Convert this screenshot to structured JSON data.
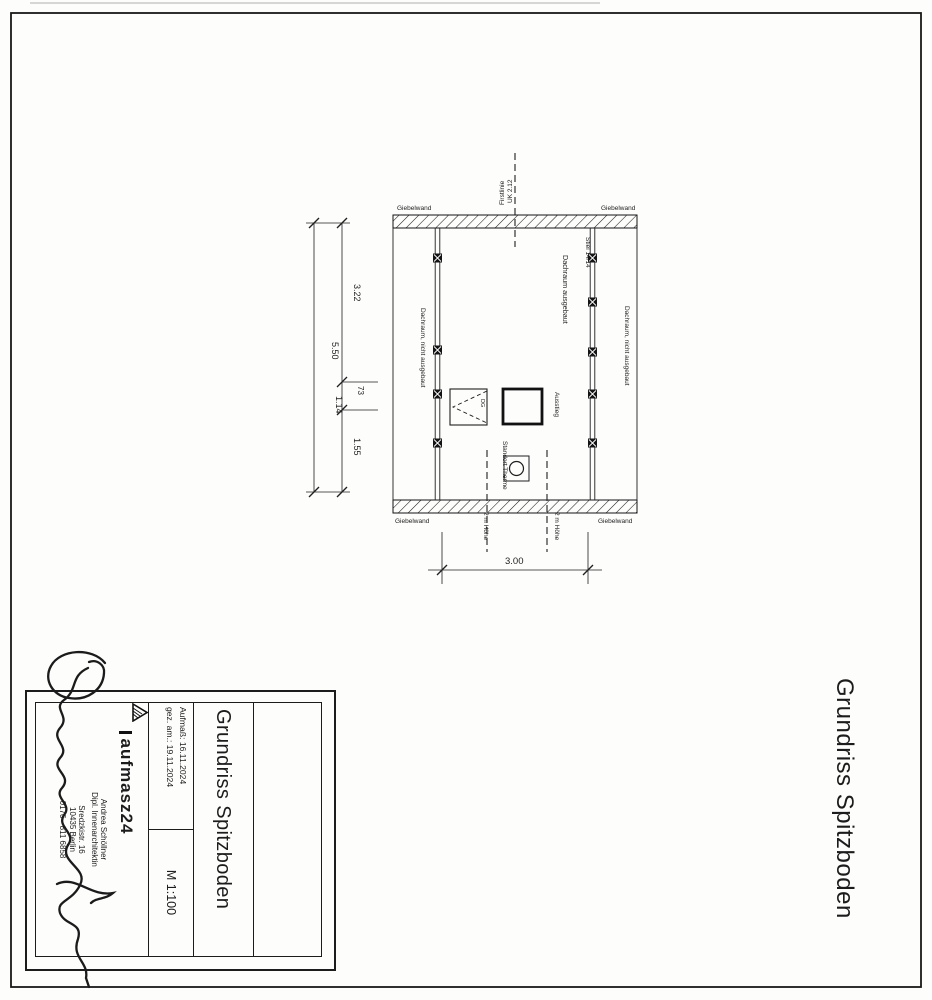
{
  "page": {
    "side_title": "Grundriss Spitzboden"
  },
  "plan": {
    "wall_labels": {
      "top_left": "Giebelwand",
      "top_right": "Giebelwand",
      "bottom_left": "Giebelwand",
      "bottom_right": "Giebelwand"
    },
    "ridge": {
      "line1": "Firstlinie",
      "line2": "UK 2.12"
    },
    "post_label": "Stiel 14/14",
    "room_center": "Dachraum ausgebaut",
    "room_left": "Dachraum, nicht ausgebaut",
    "room_right": "Dachraum, nicht ausgebaut",
    "hatch_note": "DG",
    "exit_label": "Ausstieg",
    "therme_label": "Standort Therme",
    "height_left": "2 m Höhe",
    "height_right": "2 m Höhe",
    "dims": {
      "total": "5.50",
      "top": "3.22",
      "small": "73",
      "mid": "1.14",
      "bottom": "1.55",
      "width": "3.00"
    }
  },
  "title_block": {
    "title": "Grundriss Spitzboden",
    "measured": "Aufmaß: 16.11.2024",
    "drawn": "gez. am.: 19.11.2024",
    "scale": "M 1:100",
    "company": "aufmasz24",
    "person": "Andrea Schöllner",
    "profession": "Dipl. Innenarchitektin",
    "street": "Sredzkistr. 16",
    "city": "10435 Berlin",
    "phone": "0176 - 811 6858"
  }
}
